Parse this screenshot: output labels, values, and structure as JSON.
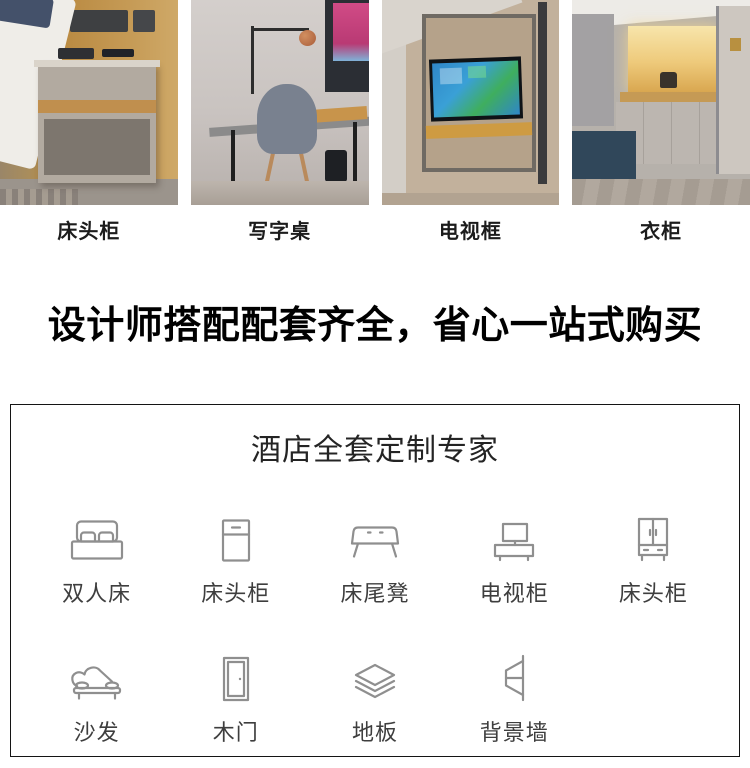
{
  "gallery": {
    "items": [
      {
        "label": "床头柜",
        "photo": "bedside-cabinet-photo"
      },
      {
        "label": "写字桌",
        "photo": "writing-desk-photo"
      },
      {
        "label": "电视框",
        "photo": "tv-frame-photo"
      },
      {
        "label": "衣柜",
        "photo": "wardrobe-photo"
      }
    ]
  },
  "headline": {
    "text": "设计师搭配配套齐全，省心一站式购买"
  },
  "panel": {
    "title": "酒店全套定制专家",
    "items_row1": [
      {
        "label": "双人床",
        "icon": "double-bed-icon"
      },
      {
        "label": "床头柜",
        "icon": "nightstand-icon"
      },
      {
        "label": "床尾凳",
        "icon": "bed-end-bench-icon"
      },
      {
        "label": "电视柜",
        "icon": "tv-cabinet-icon"
      },
      {
        "label": "床头柜",
        "icon": "wardrobe-icon"
      }
    ],
    "items_row2": [
      {
        "label": "沙发",
        "icon": "sofa-icon"
      },
      {
        "label": "木门",
        "icon": "wood-door-icon"
      },
      {
        "label": "地板",
        "icon": "floor-icon"
      },
      {
        "label": "背景墙",
        "icon": "background-wall-icon"
      }
    ],
    "colors": {
      "panel_border": "#141414",
      "icon_stroke": "#8f8f8f",
      "item_label": "#3e3e3e",
      "headline_text": "#000000",
      "photo_caption": "#1c1c1c"
    }
  }
}
